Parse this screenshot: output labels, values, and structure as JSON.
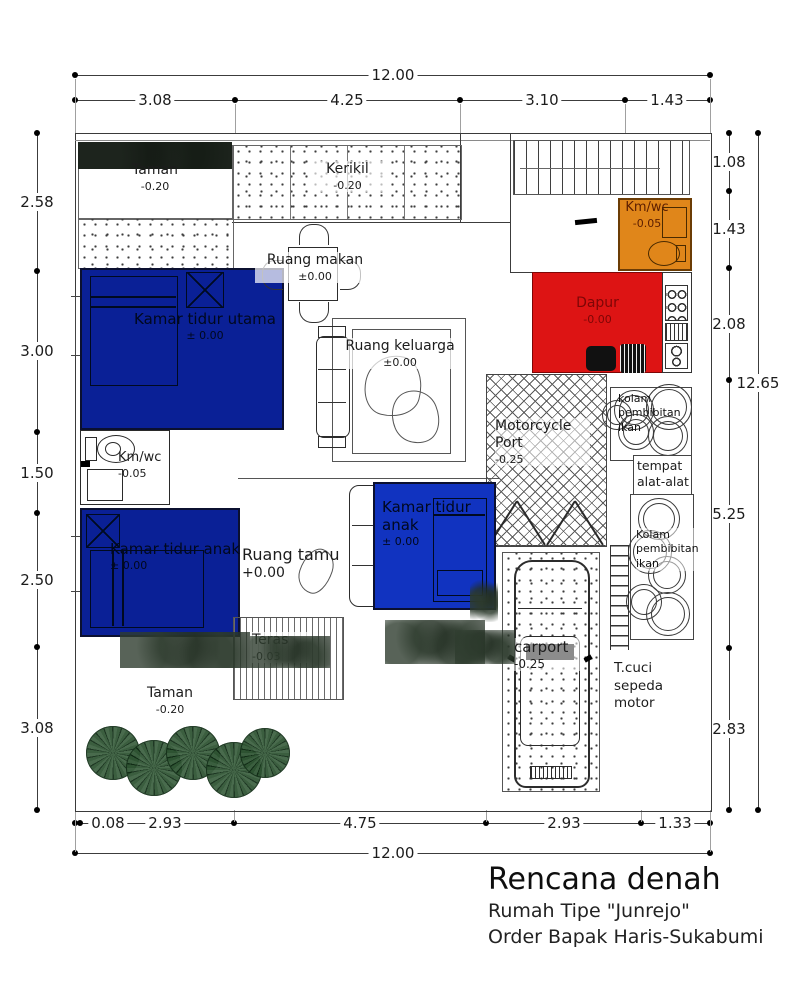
{
  "title_block": {
    "title": "Rencana denah",
    "line2": "Rumah Tipe \"Junrejo\"",
    "line3": "Order Bapak Haris-Sukabumi"
  },
  "dims": {
    "top_total": "12.00",
    "top_chain": [
      "3.08",
      "4.25",
      "3.10",
      "1.43"
    ],
    "left_chain": [
      "2.58",
      "3.00",
      "1.50",
      "2.50",
      "3.08"
    ],
    "right_chain": [
      "1.08",
      "1.43",
      "2.08",
      "5.25",
      "2.83"
    ],
    "right_total": "12.65",
    "bottom_chain": [
      "0.08",
      "2.93",
      "4.75",
      "2.93",
      "1.33"
    ],
    "bottom_total": "12.00"
  },
  "rooms": {
    "taman_top": {
      "label": "Taman",
      "elev": "-0.20"
    },
    "kerikil": {
      "label": "Kerikil",
      "elev": "-0.20"
    },
    "ruang_makan": {
      "label": "Ruang makan",
      "elev": "±0.00"
    },
    "km_wc_top": {
      "label": "Km/wc",
      "elev": "-0.05"
    },
    "dapur": {
      "label": "Dapur",
      "elev": "-0.00"
    },
    "kamar_tidur_utama": {
      "label": "Kamar tidur utama",
      "elev": "± 0.00"
    },
    "ruang_keluarga": {
      "label": "Ruang keluarga",
      "elev": "±0.00"
    },
    "motorcycle_port": {
      "label": "Motorcycle Port",
      "elev": "-0.25"
    },
    "kolam_atas": {
      "label": "kolam pembibitan ikan"
    },
    "tempat_alat": {
      "label": "tempat alat-alat"
    },
    "kolam_bawah": {
      "label": "Kolam pembibitan ikan"
    },
    "km_wc_kiri": {
      "label": "Km/wc",
      "elev": "-0.05"
    },
    "kamar_tidur_anak_kiri": {
      "label": "Kamar tidur anak",
      "elev": "± 0.00"
    },
    "ruang_tamu": {
      "label": "Ruang tamu",
      "elev": "+0.00"
    },
    "kamar_tidur_anak_kanan": {
      "label": "Kamar tidur anak",
      "elev": "± 0.00"
    },
    "teras": {
      "label": "Teras",
      "elev": "-0.03"
    },
    "taman_bawah": {
      "label": "Taman",
      "elev": "-0.20"
    },
    "carport": {
      "label": "carport",
      "elev": "-0.25"
    },
    "t_cuci": {
      "label": "T.cuci sepeda motor"
    }
  },
  "colors": {
    "bedroom_blue": "#0a2096",
    "bedroom_blue_bright": "#1133c0",
    "kitchen_red": "#dd1414",
    "bathroom_orange": "#e0861a",
    "tree_green": "#2d5231"
  }
}
